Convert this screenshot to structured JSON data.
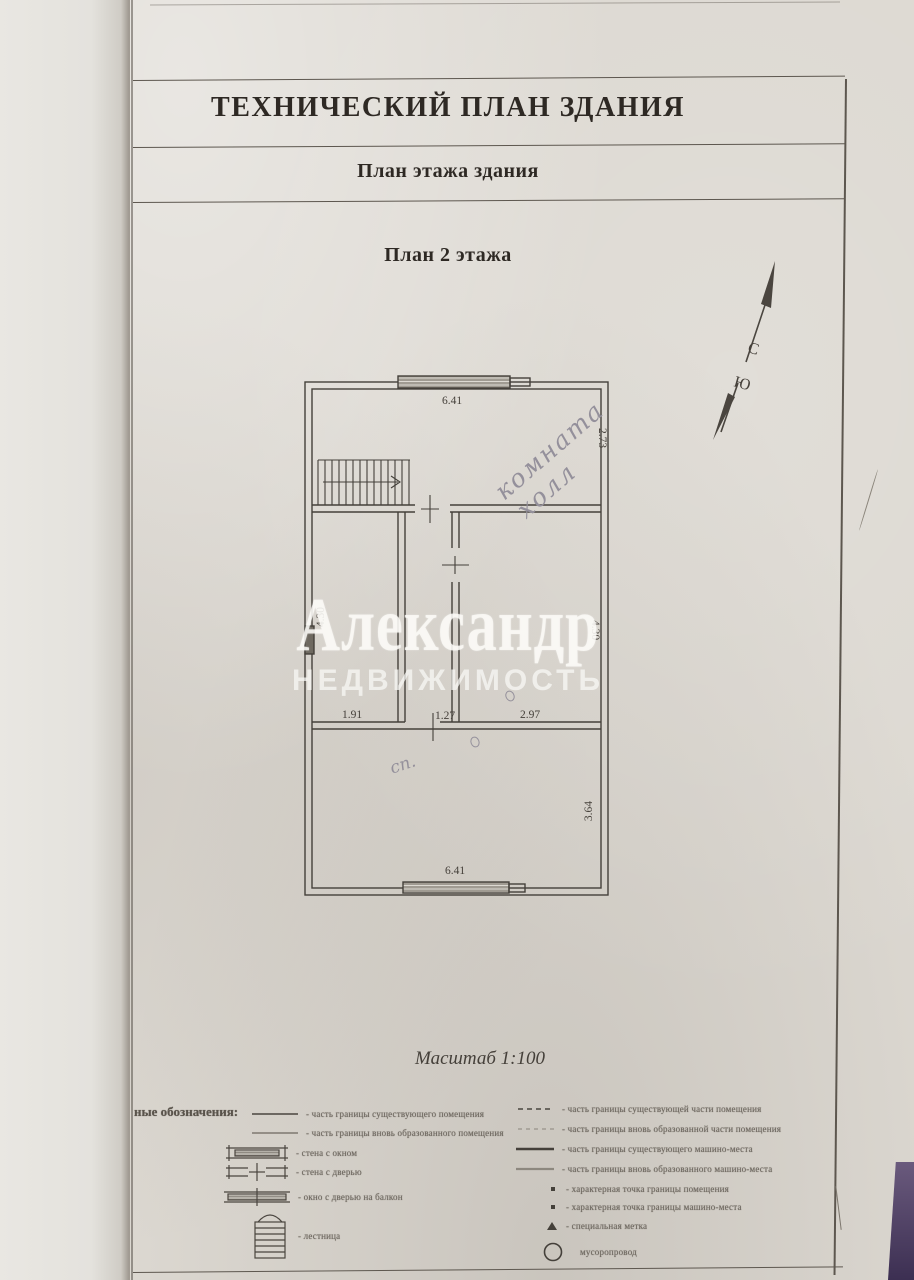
{
  "header": {
    "title": "ТЕХНИЧЕСКИЙ ПЛАН ЗДАНИЯ",
    "section": "План этажа здания",
    "plan_caption": "План 2 этажа",
    "scale": "Масштаб 1:100"
  },
  "compass": {
    "north": "С",
    "south": "Ю"
  },
  "watermark": {
    "line1": "Александр",
    "line2": "НЕДВИЖИМОСТЬ"
  },
  "plan": {
    "dimensions": {
      "top": "6.41",
      "right_top": "2.73",
      "left_mid": "4.30",
      "right_mid": "4.30",
      "inner_left": "1.91",
      "inner_mid": "1.27",
      "inner_right": "2.97",
      "right_bottom": "3.64",
      "bottom": "6.41"
    },
    "handwritten": {
      "hall_line1": "комната",
      "hall_line2": "холл",
      "bedroom": "сп."
    }
  },
  "legend": {
    "heading": "ные обозначения:",
    "left": [
      {
        "symbol": "line-solid",
        "label": "- часть границы существующего помещения"
      },
      {
        "symbol": "line-thin",
        "label": "- часть границы вновь образованного помещения"
      },
      {
        "symbol": "wall-window",
        "label": "- стена с окном"
      },
      {
        "symbol": "wall-door",
        "label": "- стена с дверью"
      },
      {
        "symbol": "window-balcony-door",
        "label": "- окно с дверью на балкон"
      },
      {
        "symbol": "stairs",
        "label": "- лестница"
      }
    ],
    "right": [
      {
        "symbol": "line-dashed",
        "label": "- часть границы существующей части помещения"
      },
      {
        "symbol": "line-dashed-light",
        "label": "- часть границы вновь образованной части помещения"
      },
      {
        "symbol": "line-bold",
        "label": "- часть границы существующего машино-места"
      },
      {
        "symbol": "line-bold-light",
        "label": "- часть границы вновь образованного машино-места"
      },
      {
        "symbol": "point",
        "label": "- характерная точка границы помещения"
      },
      {
        "symbol": "point-small",
        "label": "- характерная точка границы машино-места"
      },
      {
        "symbol": "triangle",
        "label": "- специальная метка"
      },
      {
        "symbol": "circle",
        "label": "мусоропровод"
      }
    ]
  },
  "colors": {
    "paper": "#dcd8d1",
    "ink": "#44403a",
    "pencil": "#94909b",
    "watermark": "#faf9f6",
    "photo_corner": "#4c3c60"
  }
}
